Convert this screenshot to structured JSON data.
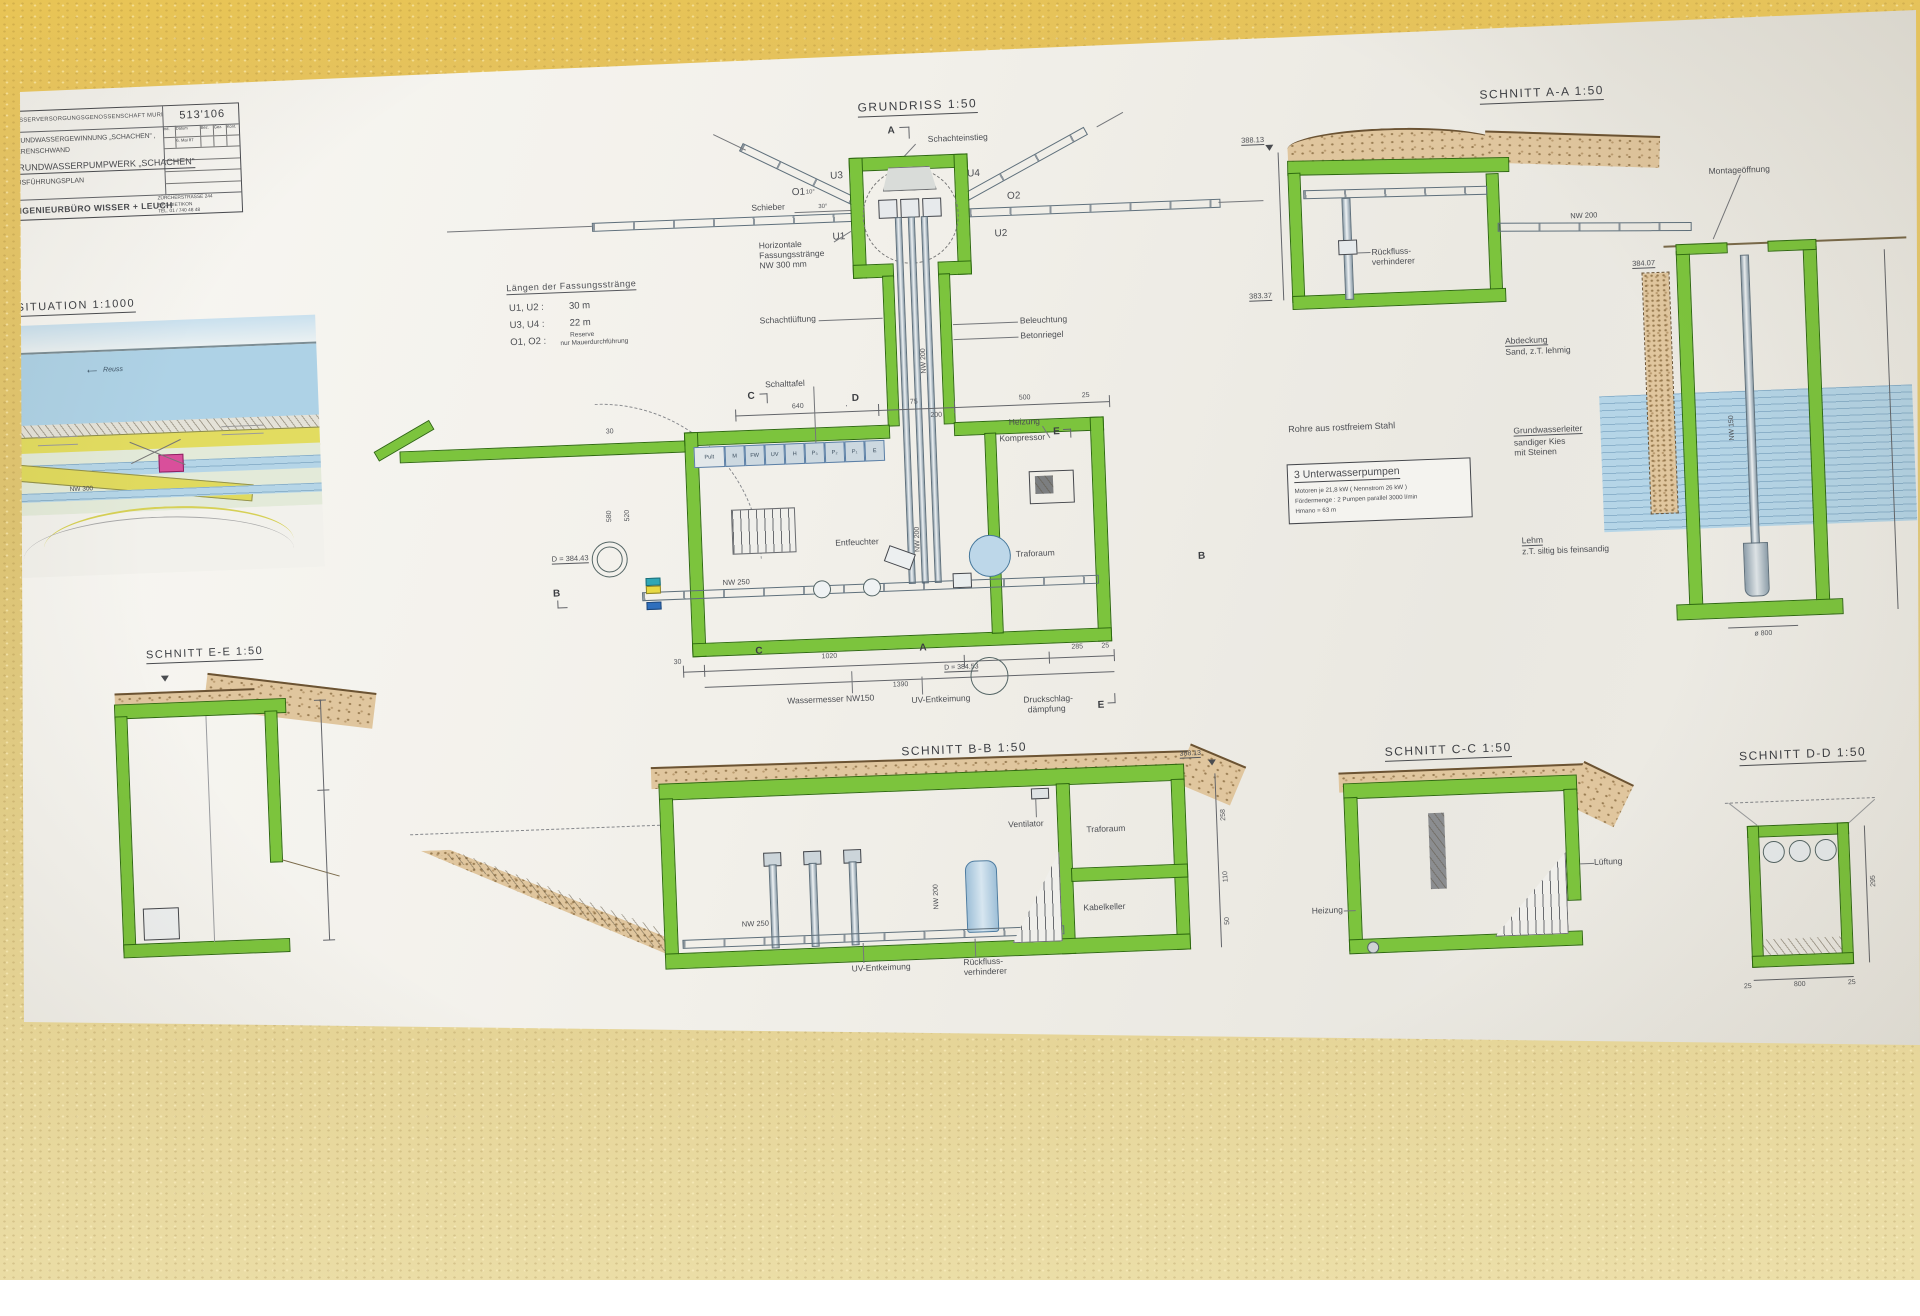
{
  "title_block": {
    "org": "WASSERVERSORGUNGSGENOSSENSCHAFT  MURI",
    "plan_no": "513'106",
    "line1": "GRUNDWASSERGEWINNUNG „SCHACHEN“ ,",
    "line2": "MERENSCHWAND",
    "main": "GRUNDWASSERPUMPWERK „SCHACHEN“",
    "doc": "AUSFÜHRUNGSPLAN",
    "firm": "INGENIEURBÜRO   WISSER + LEUCH",
    "addr1": "ZÜRCHERSTRASSE  244",
    "addr2": "8953 DIETIKON",
    "addr3": "TEL. 01 / 740 48 48",
    "rev_headers": [
      "Ind.",
      "Datum",
      "Bez.",
      "Gez.",
      "Kont."
    ],
    "rev_date": "6. Mai 87"
  },
  "situation": {
    "title": "SITUATION  1:1000",
    "river": "Reuss",
    "nw300": "NW 300"
  },
  "laengen": {
    "heading": "Längen der Fassungsstränge",
    "u12": "U1, U2 :",
    "u12v": "30 m",
    "u34": "U3, U4 :",
    "u34v": "22 m",
    "o12": "O1, O2 :",
    "o12v1": "Reserve",
    "o12v2": "nur Mauerdurchführung"
  },
  "grundriss": {
    "title": "GRUNDRISS 1:50",
    "schachteinstieg": "Schachteinstieg",
    "schieber": "Schieber",
    "u1": "U1",
    "u2": "U2",
    "u3": "U3",
    "u4": "U4",
    "o1": "O1",
    "o2": "O2",
    "a10": "10°",
    "a30": "30°",
    "horiz1": "Horizontale",
    "horiz2": "Fassungsstränge",
    "horiz3": "NW 300 mm",
    "schachtlueftung": "Schachtlüftung",
    "beleuchtung": "Beleuchtung",
    "betonriegel": "Betonriegel",
    "schalttafel": "Schalttafel",
    "cells": [
      "Pult",
      "M",
      "FW",
      "UV",
      "H",
      "P₃",
      "P₂",
      "P₁",
      "E"
    ],
    "heizung": "Heizung",
    "kompressor": "Kompressor",
    "entfeuchter": "Entfeuchter",
    "traforaum": "Traforaum",
    "nw200": "NW 200",
    "nw200b": "NW 200",
    "nw250": "NW 250",
    "wassermesser": "Wassermesser NW150",
    "uv": "UV-Entkeimung",
    "druck1": "Druckschlag-",
    "druck2": "dämpfung",
    "d1": "D = 384.43",
    "d2": "D = 384.53",
    "dim640": "640",
    "dim75": "75",
    "dim500": "500",
    "dim200": "200",
    "dim25": "25",
    "dim30": "30",
    "dim580": "580",
    "dim520": "520",
    "dim30b": "30",
    "dim1020": "1020",
    "dim1390": "1390",
    "dim285": "285",
    "dim25b": "25",
    "mA": "A",
    "mB": "B",
    "mC": "C",
    "mD": "D",
    "mE": "E"
  },
  "aa": {
    "title": "SCHNITT A-A  1:50",
    "e1": "388.13",
    "e2": "383.37",
    "e3": "384.07",
    "montage": "Montageöffnung",
    "nw200": "NW 200",
    "rf1": "Rückfluss-",
    "rf2": "verhinderer",
    "abd1": "Abdeckung",
    "abd2": "Sand, z.T. lehmig",
    "gw1": "Grundwasserleiter",
    "gw2": "sandiger  Kies",
    "gw3": "mit Steinen",
    "lehm1": "Lehm",
    "lehm2": "z.T. siltig bis feinsandig",
    "nw150": "NW 150",
    "dia": "ø 800",
    "rohre": "Rohre  aus rostfreiem  Stahl",
    "pump_head": "3 Unterwasserpumpen",
    "pump1": "Motoren  je 21,8 kW  ( Nennstrom  26 kW )",
    "pump2": "Fördermenge :  2 Pumpen parallel  3000 l/min",
    "pump3": "Hmano = 63 m"
  },
  "ee": {
    "title": "SCHNITT E-E  1:50"
  },
  "bb": {
    "title": "SCHNITT B-B 1:50",
    "ventilator": "Ventilator",
    "traforaum": "Traforaum",
    "kabelkeller": "Kabelkeller",
    "nw200": "NW 200",
    "nw250": "NW 250",
    "uv": "UV-Entkeimung",
    "rf1": "Rückfluss-",
    "rf2": "verhinderer",
    "elev": "388.13",
    "d258": "258",
    "d110": "110",
    "d50": "50"
  },
  "cc": {
    "title": "SCHNITT C-C  1:50",
    "lueftung": "Lüftung",
    "heizung": "Heizung"
  },
  "dd": {
    "title": "SCHNITT D-D  1:50",
    "d800": "800",
    "d25l": "25",
    "d25r": "25",
    "d295": "295"
  }
}
